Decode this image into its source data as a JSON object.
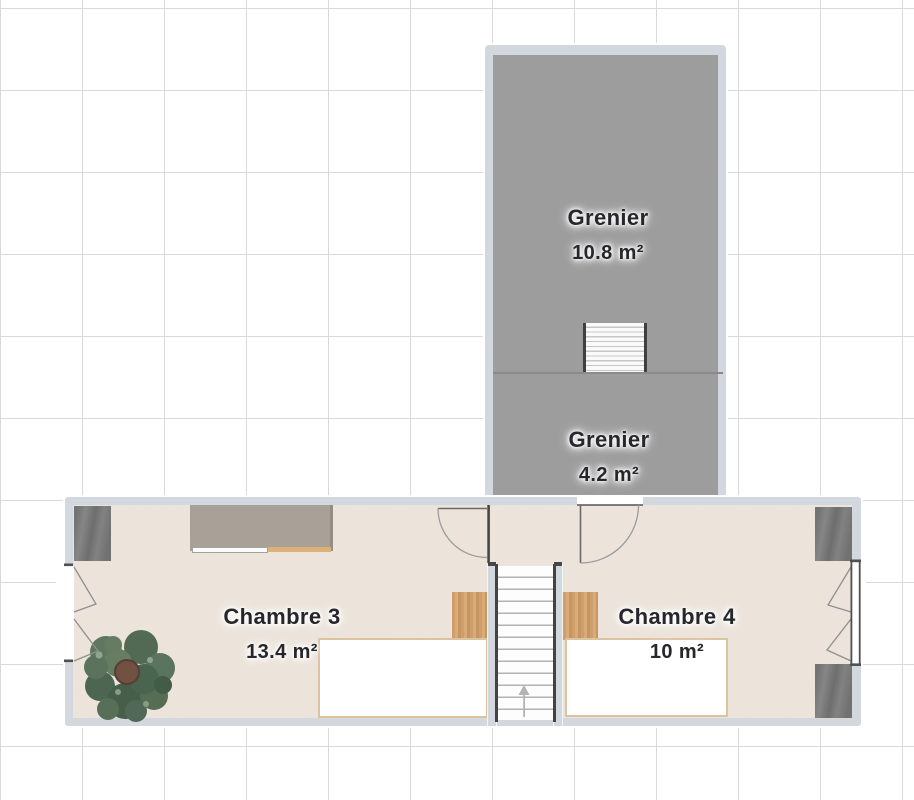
{
  "plan": {
    "type": "floor-plan",
    "rooms": [
      {
        "id": "grenier-large",
        "name": "Grenier",
        "area": "10.8 m²"
      },
      {
        "id": "grenier-small",
        "name": "Grenier",
        "area": "4.2 m²"
      },
      {
        "id": "chambre-3",
        "name": "Chambre 3",
        "area": "13.4 m²"
      },
      {
        "id": "chambre-4",
        "name": "Chambre 4",
        "area": "10 m²"
      }
    ],
    "objects": [
      "staircase-upper",
      "staircase-lower",
      "direction-arrow",
      "door-chambre-3",
      "door-grenier",
      "window-left",
      "window-right",
      "wardrobe-top-left",
      "sideboard",
      "wardrobe-top-right",
      "wardrobe-bottom-right",
      "headboard-chambre-3",
      "bed-chambre-3",
      "headboard-chambre-4",
      "bed-chambre-4",
      "plant"
    ],
    "colors": {
      "wall": "#d3d8de",
      "attic_floor": "#9e9c9c",
      "room_floor": "#f3ece5",
      "grid_line": "#d9d9d9",
      "dark_furniture": "#7c7c7c",
      "sideboard": "#a9a197",
      "wood": "#d3a271",
      "bed_border": "#dcc3a0",
      "plant_green": "#4d6751",
      "label_text": "#26262b"
    }
  }
}
